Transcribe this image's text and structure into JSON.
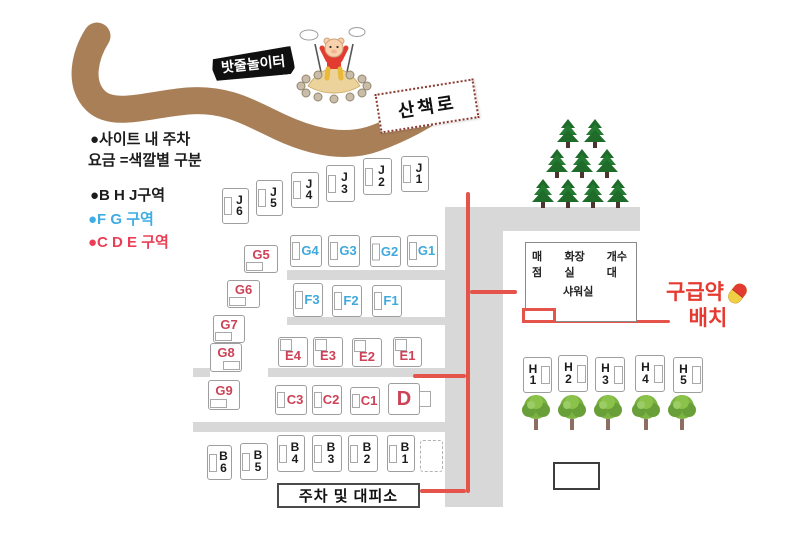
{
  "legend": {
    "parking_note_line1": "●사이트 내 주차",
    "parking_note_line2": "요금 =색깔별 구분",
    "zone_bhj": "●B H J구역",
    "zone_fg": "●F G 구역",
    "zone_cde": "●C D E 구역"
  },
  "signs": {
    "rope_playground": "밧줄놀이터",
    "walking_trail": "산책로",
    "parking_shelter": "주차 및 대피소",
    "first_aid_line1": "구급약",
    "first_aid_line2": "배치"
  },
  "facility": {
    "item1": "매점",
    "item2": "화장실",
    "item3": "개수대",
    "shower": "샤워실"
  },
  "colors": {
    "site_black": "#1c1c1c",
    "site_blue": "#3fa9dc",
    "site_red": "#cc4257",
    "legend_blue": "#3fade4",
    "legend_red": "#ea3f56",
    "red_line": "#e4544b",
    "first_aid": "#e63a30",
    "road": "#d8d8d8",
    "path_brown": "#a97f58"
  },
  "sites": [
    {
      "id": "J6",
      "lines": [
        "J",
        "6"
      ],
      "group": "black",
      "x": 222,
      "y": 188,
      "w": 27,
      "h": 36,
      "tab": "left"
    },
    {
      "id": "J5",
      "lines": [
        "J",
        "5"
      ],
      "group": "black",
      "x": 256,
      "y": 180,
      "w": 27,
      "h": 36,
      "tab": "left"
    },
    {
      "id": "J4",
      "lines": [
        "J",
        "4"
      ],
      "group": "black",
      "x": 291,
      "y": 172,
      "w": 28,
      "h": 36,
      "tab": "left"
    },
    {
      "id": "J3",
      "lines": [
        "J",
        "3"
      ],
      "group": "black",
      "x": 326,
      "y": 165,
      "w": 29,
      "h": 37,
      "tab": "left"
    },
    {
      "id": "J2",
      "lines": [
        "J",
        "2"
      ],
      "group": "black",
      "x": 363,
      "y": 158,
      "w": 29,
      "h": 37,
      "tab": "left"
    },
    {
      "id": "J1",
      "lines": [
        "J",
        "1"
      ],
      "group": "black",
      "x": 401,
      "y": 156,
      "w": 28,
      "h": 36,
      "tab": "left"
    },
    {
      "id": "G4",
      "lines": [
        "G4"
      ],
      "group": "blue",
      "x": 290,
      "y": 235,
      "w": 32,
      "h": 32,
      "tab": "left"
    },
    {
      "id": "G3",
      "lines": [
        "G3"
      ],
      "group": "blue",
      "x": 328,
      "y": 235,
      "w": 32,
      "h": 32,
      "tab": "left"
    },
    {
      "id": "G2",
      "lines": [
        "G2"
      ],
      "group": "blue",
      "x": 370,
      "y": 236,
      "w": 31,
      "h": 31,
      "tab": "left"
    },
    {
      "id": "G1",
      "lines": [
        "G1"
      ],
      "group": "blue",
      "x": 407,
      "y": 235,
      "w": 31,
      "h": 32,
      "tab": "left"
    },
    {
      "id": "G5",
      "lines": [
        "G5"
      ],
      "group": "red",
      "x": 244,
      "y": 245,
      "w": 34,
      "h": 28,
      "tab": "bottom-left"
    },
    {
      "id": "G6",
      "lines": [
        "G6"
      ],
      "group": "red",
      "x": 227,
      "y": 280,
      "w": 33,
      "h": 28,
      "tab": "bottom-left"
    },
    {
      "id": "G7",
      "lines": [
        "G7"
      ],
      "group": "red",
      "x": 213,
      "y": 315,
      "w": 32,
      "h": 28,
      "tab": "bottom-left"
    },
    {
      "id": "G8",
      "lines": [
        "G8"
      ],
      "group": "red",
      "x": 210,
      "y": 343,
      "w": 32,
      "h": 29,
      "tab": "bottom-right"
    },
    {
      "id": "G9",
      "lines": [
        "G9"
      ],
      "group": "red",
      "x": 208,
      "y": 380,
      "w": 32,
      "h": 30,
      "tab": "bottom-left"
    },
    {
      "id": "F3",
      "lines": [
        "F3"
      ],
      "group": "blue",
      "x": 293,
      "y": 283,
      "w": 30,
      "h": 34,
      "tab": "left"
    },
    {
      "id": "F2",
      "lines": [
        "F2"
      ],
      "group": "blue",
      "x": 332,
      "y": 285,
      "w": 30,
      "h": 32,
      "tab": "left"
    },
    {
      "id": "F1",
      "lines": [
        "F1"
      ],
      "group": "blue",
      "x": 372,
      "y": 285,
      "w": 30,
      "h": 32,
      "tab": "left"
    },
    {
      "id": "E4",
      "lines": [
        "E4"
      ],
      "group": "red",
      "x": 278,
      "y": 337,
      "w": 30,
      "h": 30,
      "tab": "top-left"
    },
    {
      "id": "E3",
      "lines": [
        "E3"
      ],
      "group": "red",
      "x": 313,
      "y": 337,
      "w": 30,
      "h": 30,
      "tab": "top-left"
    },
    {
      "id": "E2",
      "lines": [
        "E2"
      ],
      "group": "red",
      "x": 352,
      "y": 338,
      "w": 30,
      "h": 29,
      "tab": "top-left"
    },
    {
      "id": "E1",
      "lines": [
        "E1"
      ],
      "group": "red",
      "x": 393,
      "y": 337,
      "w": 29,
      "h": 30,
      "tab": "top-left"
    },
    {
      "id": "C3",
      "lines": [
        "C3"
      ],
      "group": "red",
      "x": 275,
      "y": 385,
      "w": 32,
      "h": 30,
      "tab": "left"
    },
    {
      "id": "C2",
      "lines": [
        "C2"
      ],
      "group": "red",
      "x": 312,
      "y": 385,
      "w": 30,
      "h": 30,
      "tab": "left"
    },
    {
      "id": "C1",
      "lines": [
        "C1"
      ],
      "group": "red",
      "x": 350,
      "y": 387,
      "w": 30,
      "h": 28,
      "tab": "left"
    },
    {
      "id": "D",
      "lines": [
        "D"
      ],
      "group": "red",
      "x": 388,
      "y": 383,
      "w": 32,
      "h": 32,
      "tab": "right-out",
      "big": true
    },
    {
      "id": "B6",
      "lines": [
        "B",
        "6"
      ],
      "group": "black",
      "x": 207,
      "y": 445,
      "w": 25,
      "h": 35,
      "tab": "left"
    },
    {
      "id": "B5",
      "lines": [
        "B",
        "5"
      ],
      "group": "black",
      "x": 240,
      "y": 443,
      "w": 28,
      "h": 37,
      "tab": "left"
    },
    {
      "id": "B4",
      "lines": [
        "B",
        "4"
      ],
      "group": "black",
      "x": 277,
      "y": 435,
      "w": 28,
      "h": 37,
      "tab": "left"
    },
    {
      "id": "B3",
      "lines": [
        "B",
        "3"
      ],
      "group": "black",
      "x": 312,
      "y": 435,
      "w": 30,
      "h": 37,
      "tab": "left"
    },
    {
      "id": "B2",
      "lines": [
        "B",
        "2"
      ],
      "group": "black",
      "x": 348,
      "y": 435,
      "w": 30,
      "h": 37,
      "tab": "left"
    },
    {
      "id": "B1",
      "lines": [
        "B",
        "1"
      ],
      "group": "black",
      "x": 387,
      "y": 435,
      "w": 28,
      "h": 37,
      "tab": "left"
    },
    {
      "id": "H1",
      "lines": [
        "H",
        "1"
      ],
      "group": "black",
      "x": 523,
      "y": 357,
      "w": 29,
      "h": 36,
      "tab": "right"
    },
    {
      "id": "H2",
      "lines": [
        "H",
        "2"
      ],
      "group": "black",
      "x": 558,
      "y": 355,
      "w": 30,
      "h": 37,
      "tab": "right"
    },
    {
      "id": "H3",
      "lines": [
        "H",
        "3"
      ],
      "group": "black",
      "x": 595,
      "y": 357,
      "w": 30,
      "h": 35,
      "tab": "right"
    },
    {
      "id": "H4",
      "lines": [
        "H",
        "4"
      ],
      "group": "black",
      "x": 635,
      "y": 355,
      "w": 30,
      "h": 37,
      "tab": "right"
    },
    {
      "id": "H5",
      "lines": [
        "H",
        "5"
      ],
      "group": "black",
      "x": 673,
      "y": 357,
      "w": 30,
      "h": 36,
      "tab": "right"
    }
  ],
  "roads": [
    {
      "x": 445,
      "y": 207,
      "w": 195,
      "h": 24
    },
    {
      "x": 445,
      "y": 207,
      "w": 58,
      "h": 300
    },
    {
      "x": 287,
      "y": 270,
      "w": 158,
      "h": 10
    },
    {
      "x": 287,
      "y": 317,
      "w": 158,
      "h": 8
    },
    {
      "x": 193,
      "y": 368,
      "w": 17,
      "h": 9
    },
    {
      "x": 268,
      "y": 368,
      "w": 177,
      "h": 9
    },
    {
      "x": 193,
      "y": 422,
      "w": 252,
      "h": 10
    }
  ],
  "red_lines": [
    {
      "x": 466,
      "y": 192,
      "w": 4,
      "h": 301
    },
    {
      "x": 470,
      "y": 290,
      "w": 47,
      "h": 4
    },
    {
      "x": 413,
      "y": 374,
      "w": 53,
      "h": 4
    },
    {
      "x": 420,
      "y": 489,
      "w": 46,
      "h": 4
    },
    {
      "x": 523,
      "y": 320,
      "w": 147,
      "h": 3
    }
  ],
  "first_aid_marker": {
    "x": 522,
    "y": 308,
    "w": 34,
    "h": 15
  },
  "building": {
    "x": 525,
    "y": 242,
    "w": 112,
    "h": 80
  },
  "parking_box": {
    "x": 277,
    "y": 483,
    "w": 143,
    "h": 25
  },
  "white_box": {
    "x": 553,
    "y": 462,
    "w": 47,
    "h": 28
  },
  "dashed_box": {
    "x": 420,
    "y": 440,
    "w": 23,
    "h": 32
  },
  "trees": {
    "pines": [
      [
        555,
        118
      ],
      [
        582,
        118
      ],
      [
        544,
        148
      ],
      [
        569,
        148
      ],
      [
        594,
        148
      ],
      [
        530,
        178
      ],
      [
        555,
        178
      ],
      [
        580,
        178
      ],
      [
        605,
        178
      ]
    ],
    "round": [
      [
        520,
        393
      ],
      [
        556,
        393
      ],
      [
        592,
        393
      ],
      [
        630,
        393
      ],
      [
        666,
        393
      ]
    ]
  }
}
